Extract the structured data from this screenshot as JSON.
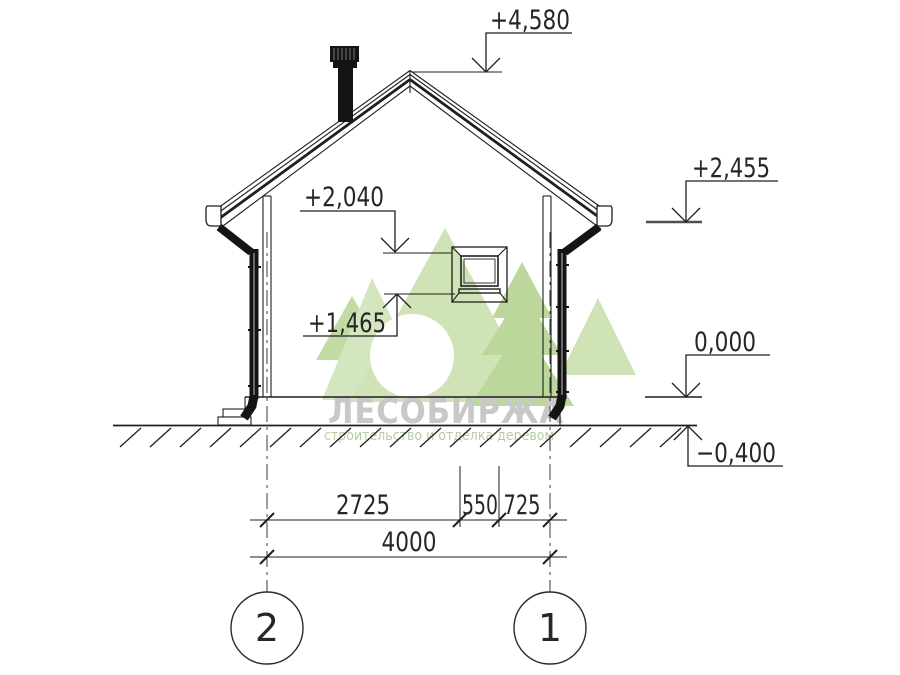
{
  "watermark": {
    "brand": "ЛЕСОБИРЖА",
    "tagline": "строительство и отделка деревом"
  },
  "elevations": {
    "ridge": "+4,580",
    "eave": "+2,455",
    "window_top": "+2,040",
    "window_sill": "+1,465",
    "floor": "0,000",
    "ground": "−0,400"
  },
  "dimensions": {
    "upper": [
      "2725",
      "550",
      "725"
    ],
    "lower": [
      "4000"
    ]
  },
  "axes": [
    {
      "label": "2"
    },
    {
      "label": "1"
    }
  ],
  "colors": {
    "line": "#1f1f1f",
    "level_line_gray": "#4f4f4f",
    "brand_gray": "#c8c8c8",
    "tagline_green": "#b9cda3",
    "tree_light": "#d4e6bf",
    "tree_mid": "#c2dba4",
    "tree_dark": "#b3d190"
  }
}
